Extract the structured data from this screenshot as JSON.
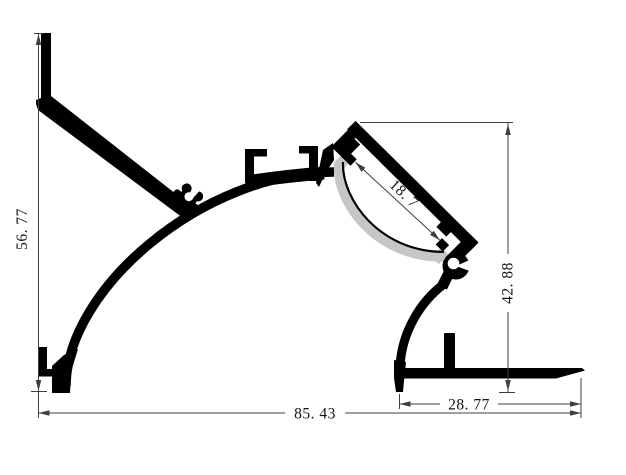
{
  "drawing": {
    "kind": "profile-cross-section-dimension-drawing",
    "background_color": "#ffffff",
    "profile_color": "#000000",
    "diffuser_color": "#c6c6c6",
    "dimension_line_color": "#3f3f3f",
    "dimension_text_color": "#141414",
    "dimensions": {
      "left_height": {
        "label": "56. 77",
        "orientation": "vertical-left"
      },
      "overall_width": {
        "label": "85. 43",
        "orientation": "horizontal-bottom"
      },
      "right_base_width": {
        "label": "28. 77",
        "orientation": "horizontal-bottom"
      },
      "right_height": {
        "label": "42. 88",
        "orientation": "vertical-right"
      },
      "channel_opening": {
        "label": "18. 7",
        "orientation": "diagonal-in-channel"
      }
    }
  }
}
